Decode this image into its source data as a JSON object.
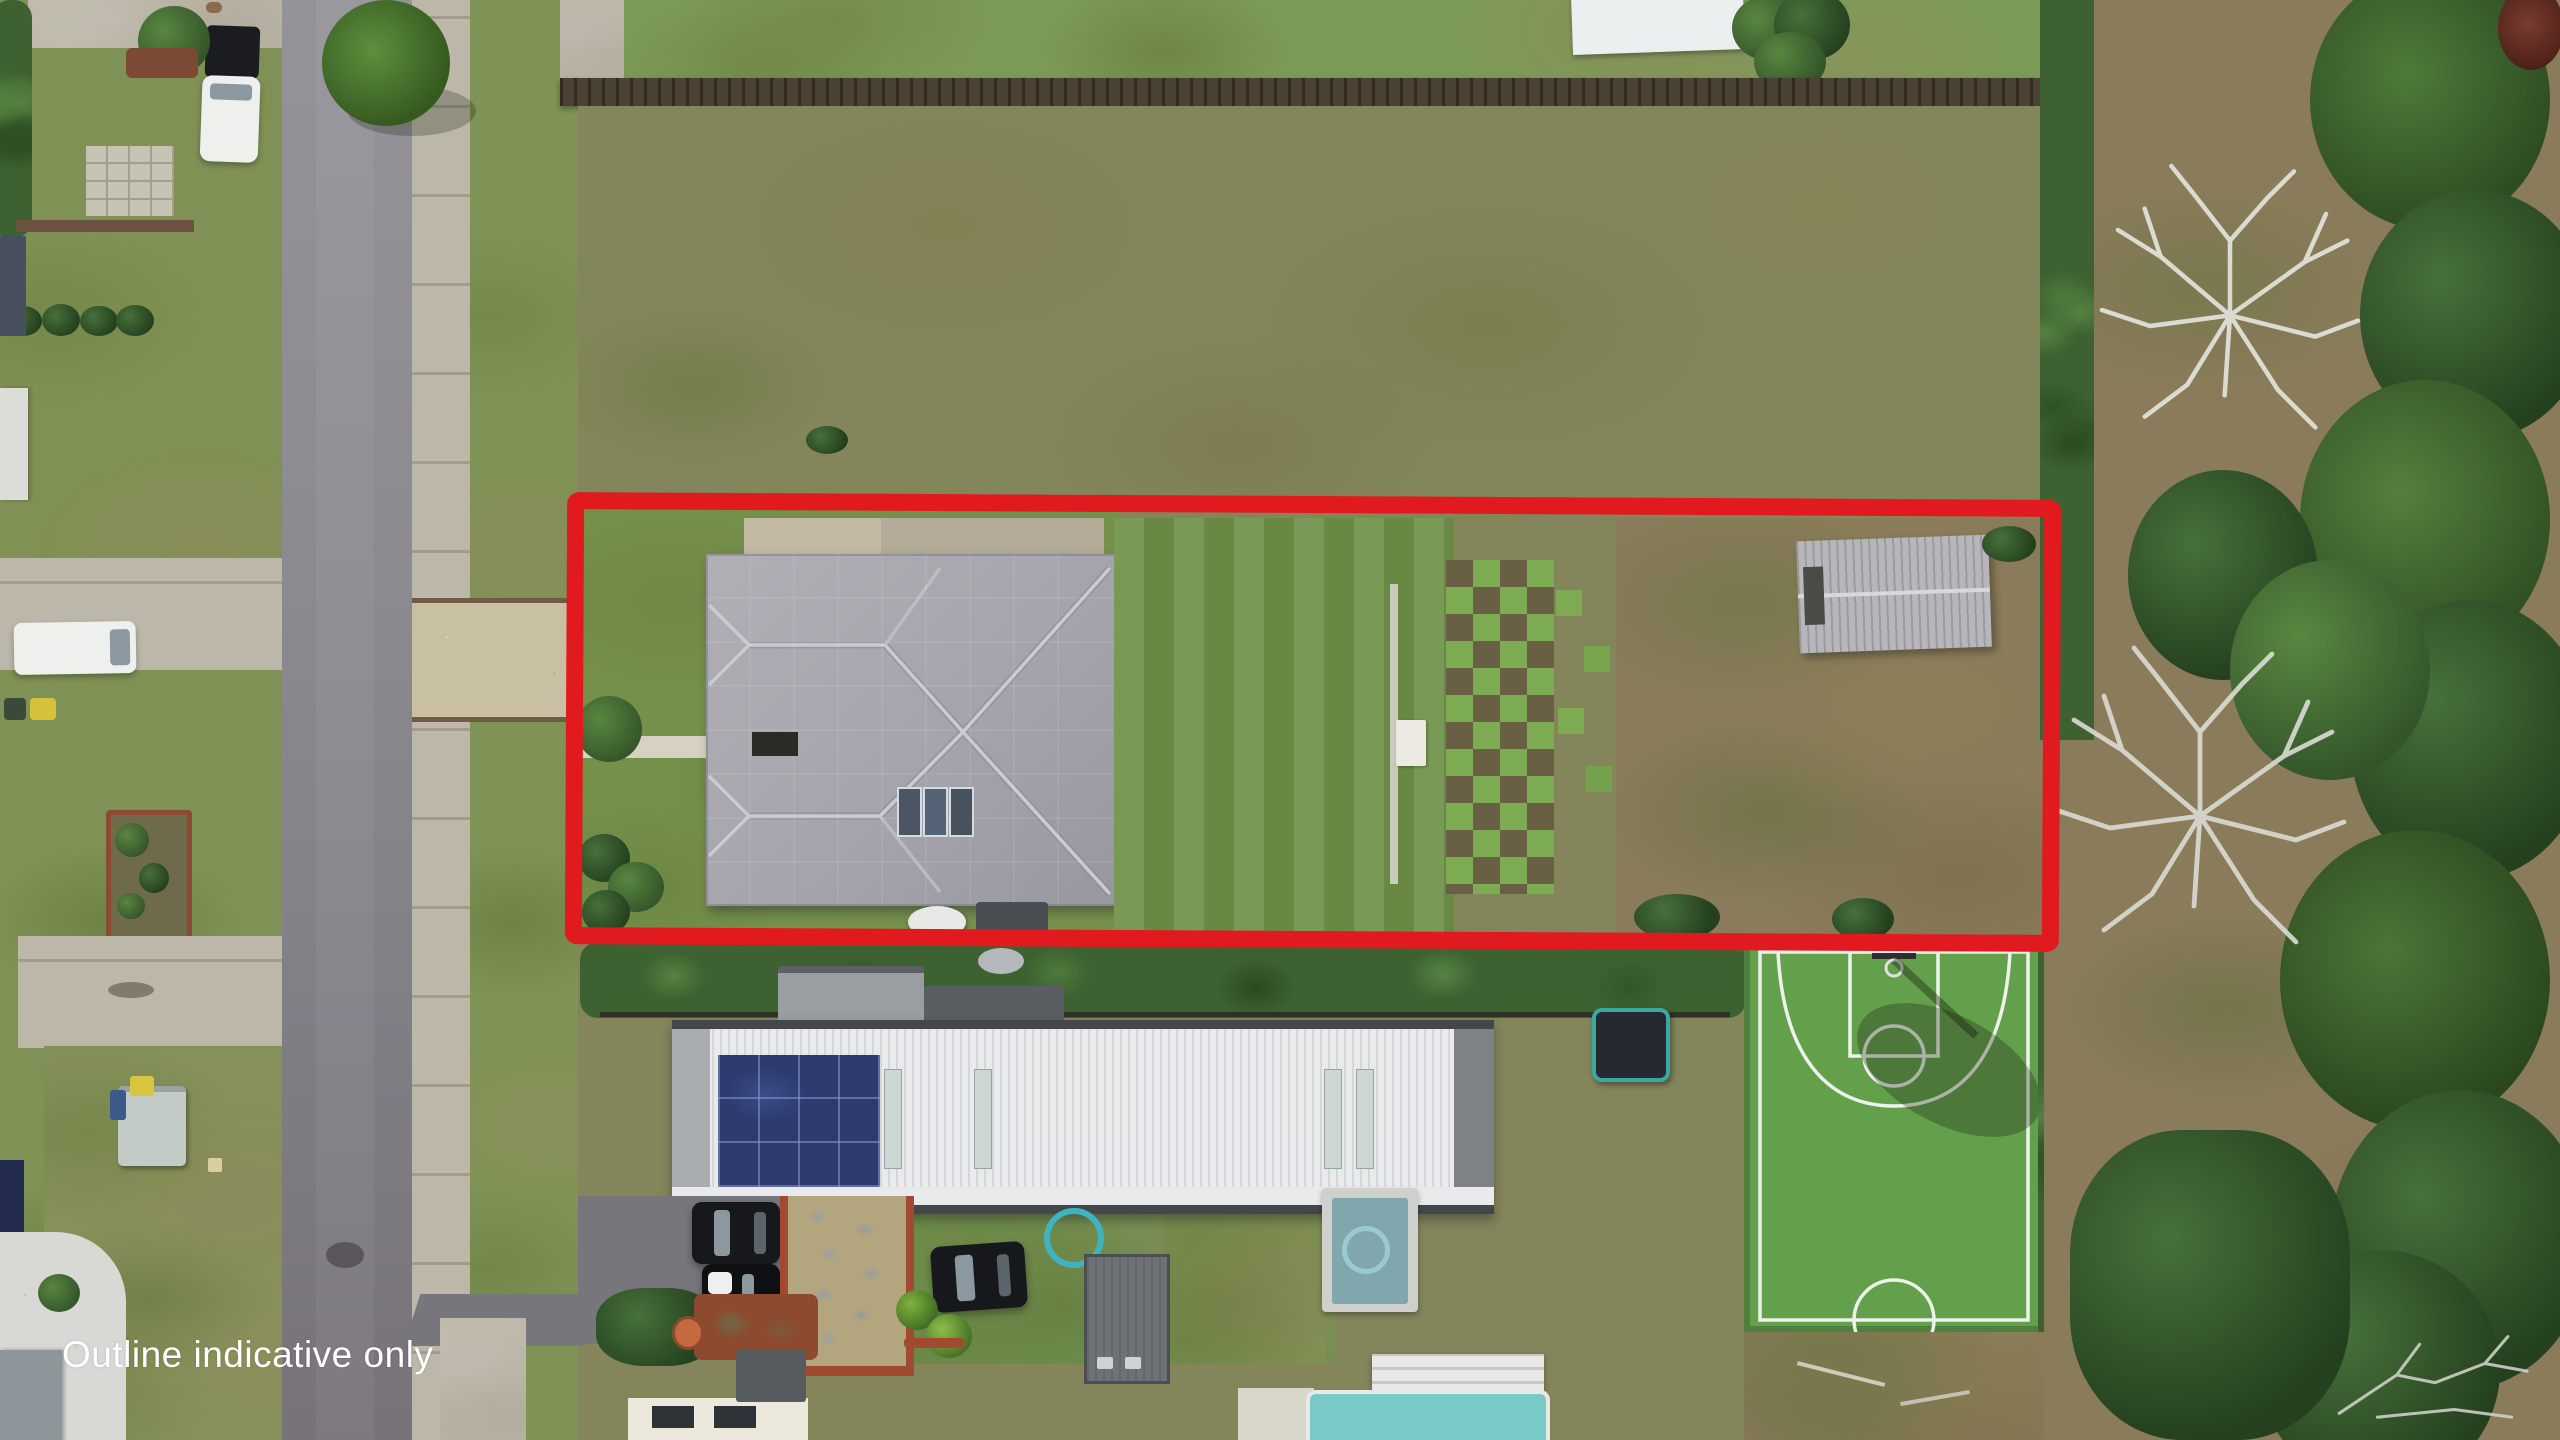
{
  "watermark": {
    "text": "Outline indicative only",
    "color": "#ffffff"
  },
  "annotation": {
    "type": "property-boundary-outline",
    "shape": "rectangle",
    "color": "#e11a1f"
  },
  "palette": {
    "road_asphalt": "#8b8a90",
    "sidewalk_concrete": "#bcb7a8",
    "lawn_green": "#7f9154",
    "field_olive": "#83865a",
    "scrub_brown": "#8a7c5a",
    "main_roof_gray": "#a5a4ac",
    "shed_gray": "#b7b6ba",
    "lower_roof_white": "#e9eaec",
    "solar_panel_navy": "#2c3a6e",
    "pool_turquoise": "#79c9c6",
    "plunge_pool_teal": "#7fa7ad",
    "court_green": "#63a04c",
    "court_lines": "#eef2ea",
    "hedge_dark_green": "#3d6130",
    "dead_tree_white": "#e2e3dc"
  },
  "scene_objects": [
    "aerial-photo",
    "street-road",
    "footpath",
    "front-driveway",
    "main-house-roof",
    "roof-skylights",
    "garden-shed",
    "turf-checkerboard",
    "mowed-lawn",
    "back-paddock",
    "boundary-fence",
    "neighbor-house-roof",
    "solar-panel-array",
    "basketball-court",
    "basketball-hoop",
    "trampoline",
    "swimming-pool",
    "plunge-pool",
    "parked-cars",
    "white-van",
    "white-ute",
    "bushland",
    "dead-trees",
    "hedges",
    "wheelie-bins",
    "hot-water-tank"
  ]
}
